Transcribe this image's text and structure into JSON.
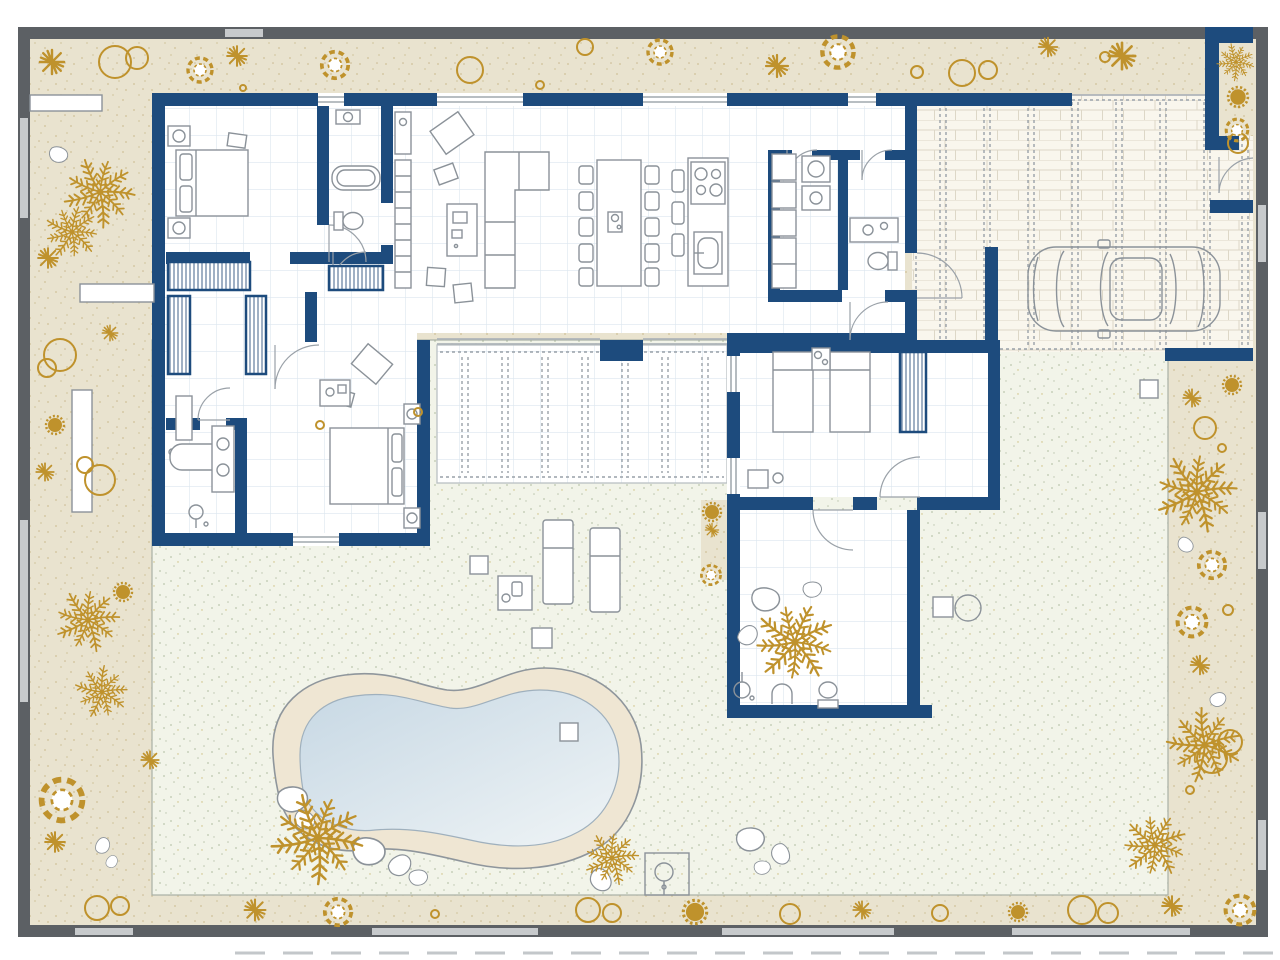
{
  "meta": {
    "description": "Colored architectural site / floor plan of a single-storey villa with garden, kidney-shaped swimming pool, wood deck pergola and brick-paved carport with a car",
    "view": "top-down plan",
    "visible_text": "none"
  },
  "colors": {
    "frame": "#5c6064",
    "gate": "#c7cacc",
    "bedBase": "#e9e3cf",
    "bedDot": "#d5c9a5",
    "gold": "#bf922c",
    "navy": "#1d4b7d",
    "grid": "#dce6ef",
    "furn": "#8b9299",
    "greenBase": "#f2f4e9",
    "greenDot": "#bcc6ae",
    "brickBase": "#f9f6ed",
    "brickLine": "#ddd7c7",
    "dash": "#99a1a9",
    "sand": "#efe6d3",
    "sandLine": "#8f969c",
    "water1": "#c7d8e4",
    "water2": "#eff4f6",
    "hatch": "#42628a",
    "doorArc": "#9aa1a8"
  },
  "rooms": [
    "master-bedroom",
    "bathroom-1",
    "dressing-hall",
    "bathroom-2",
    "bedroom-2",
    "living-room",
    "dining-area",
    "kitchen",
    "utility-room",
    "wc",
    "entry-hall",
    "bedroom-3",
    "bathroom-3"
  ],
  "outdoor_features": [
    "site-boundary-wall-with-gates",
    "perimeter-planting-bed",
    "lawn-garden",
    "deck-pergola",
    "swimming-pool",
    "pool-sand-surround",
    "carport-driveway",
    "parked-car",
    "sun-loungers",
    "outdoor-shower",
    "stepping-stones",
    "garden-benches"
  ],
  "furniture": [
    "double-bed",
    "single-beds",
    "nightstands",
    "wardrobes-hatched",
    "l-shaped-sofa",
    "armchair",
    "sideboard",
    "dining-table-10-chairs",
    "kitchen-island-hob-sink",
    "bar-stools",
    "washing-machine",
    "bathtub",
    "double-vanity",
    "showers",
    "toilets",
    "sinks"
  ],
  "flora": {
    "palm_trees": 11,
    "shrubs_rings": 24,
    "scallop_bushes": 11,
    "star_bursts": 16,
    "rocks": 17
  }
}
